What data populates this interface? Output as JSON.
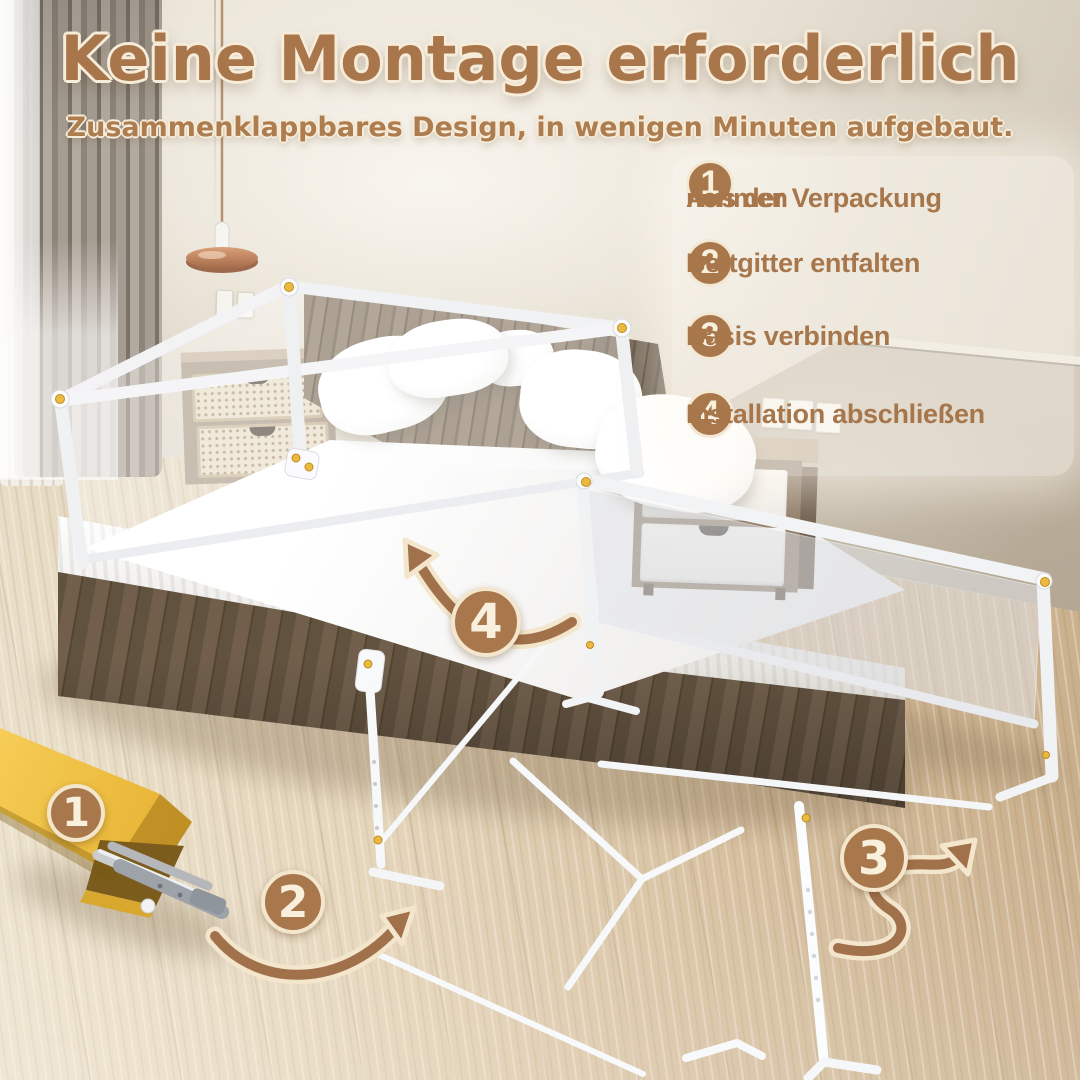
{
  "title": "Keine Montage erforderlich",
  "subtitle": "Zusammenklappbares Design, in wenigen Minuten aufgebaut.",
  "steps": [
    {
      "num": "1",
      "lines": [
        "Aus der Verpackung",
        "nehmen"
      ]
    },
    {
      "num": "2",
      "lines": [
        "Bettgitter entfalten",
        ""
      ]
    },
    {
      "num": "3",
      "lines": [
        "Basis verbinden",
        ""
      ]
    },
    {
      "num": "4",
      "lines": [
        "Installation abschließen",
        ""
      ]
    }
  ],
  "scene_markers": [
    {
      "num": "1"
    },
    {
      "num": "2"
    },
    {
      "num": "3"
    },
    {
      "num": "4"
    }
  ],
  "colors": {
    "accent_brown": "#a8764a",
    "badge_brown": "#a9774c",
    "cream_outline": "#f6ecd9",
    "box_yellow": "#eebc42"
  }
}
